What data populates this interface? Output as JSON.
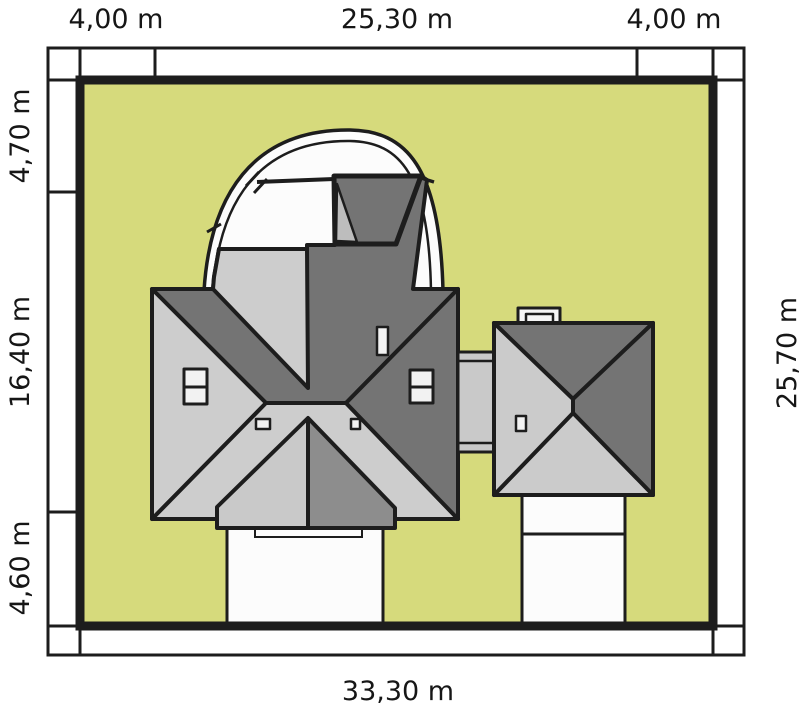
{
  "diagram": {
    "type": "architectural-site-plan",
    "labels": {
      "top_left": "4,00 m",
      "top_center": "25,30 m",
      "top_right": "4,00 m",
      "left_top": "4,70 m",
      "left_middle": "16,40 m",
      "left_bottom": "4,60 m",
      "right_side": "25,70 m",
      "bottom": "33,30 m"
    },
    "plot": {
      "total_width": "33,30 m",
      "total_depth": "25,70 m",
      "colors": {
        "plot_fill": "#d6da7c",
        "roof_light": "#cdcdcd",
        "roof_mid": "#8d8d8d",
        "roof_dark": "#747474",
        "outline": "#1d1d1d",
        "paving_white": "#fcfcfc"
      }
    },
    "elements": {
      "house": "hip-roof house with curved canopy",
      "garage": "detached hip-roof garage",
      "connector": "passage between house and garage",
      "driveway": "driveway",
      "terrace": "terrace"
    }
  }
}
